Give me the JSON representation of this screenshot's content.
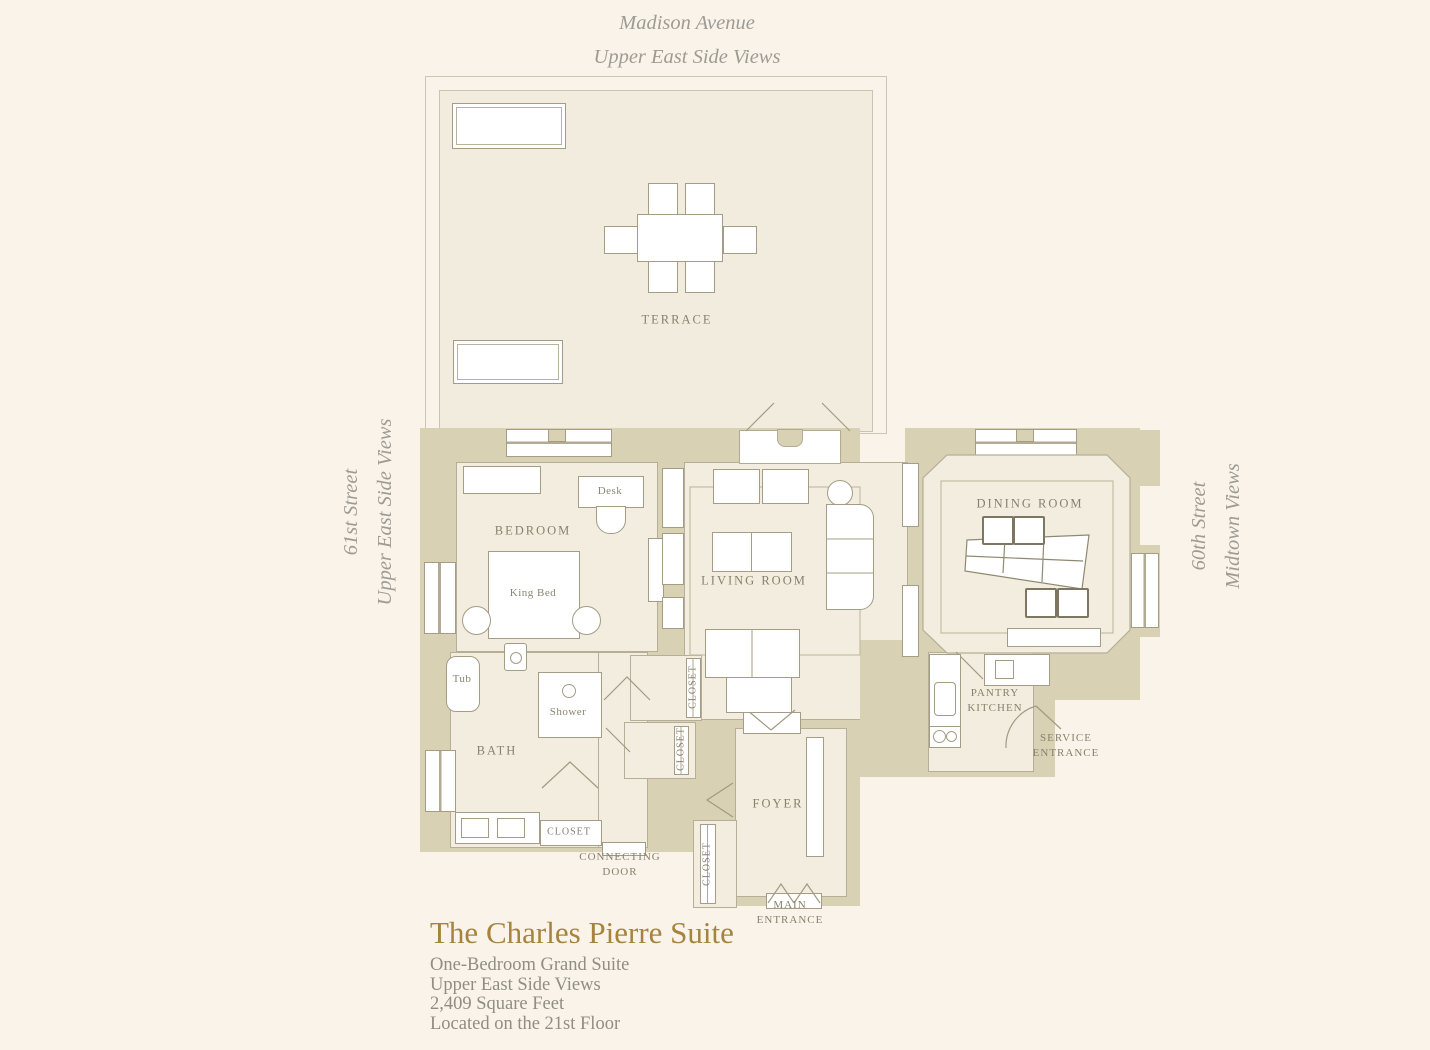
{
  "streets": {
    "top": {
      "line1": "Madison Avenue",
      "line2": "Upper East Side Views"
    },
    "left": {
      "line1": "61st Street",
      "line2": "Upper East Side Views"
    },
    "right": {
      "line1": "60th Street",
      "line2": "Midtown Views"
    }
  },
  "rooms": {
    "terrace": "TERRACE",
    "bedroom": "BEDROOM",
    "living_room": "LIVING ROOM",
    "dining_room": "DINING ROOM",
    "bath": "BATH",
    "foyer": "FOYER",
    "pantry_kitchen": {
      "line1": "PANTRY",
      "line2": "KITCHEN"
    },
    "closet": "CLOSET"
  },
  "furniture": {
    "desk": "Desk",
    "king_bed": "King Bed",
    "tub": "Tub",
    "shower": "Shower"
  },
  "annotations": {
    "service_entrance": {
      "line1": "SERVICE",
      "line2": "ENTRANCE"
    },
    "main_entrance": {
      "line1": "MAIN",
      "line2": "ENTRANCE"
    },
    "connecting_door": {
      "line1": "CONNECTING",
      "line2": "DOOR"
    }
  },
  "footer": {
    "title": "The Charles Pierre Suite",
    "details": [
      "One-Bedroom Grand Suite",
      "Upper East Side Views",
      "2,409 Square Feet",
      "Located on the 21st Floor"
    ]
  },
  "colors": {
    "background": "#faf3e9",
    "wall": "#d8d1b4",
    "room_fill": "#f2edde",
    "terrace_fill": "#f1ecdd",
    "accent_gold": "#a5843e",
    "label_gray": "#87816f",
    "street_gray": "#9d9b95"
  }
}
